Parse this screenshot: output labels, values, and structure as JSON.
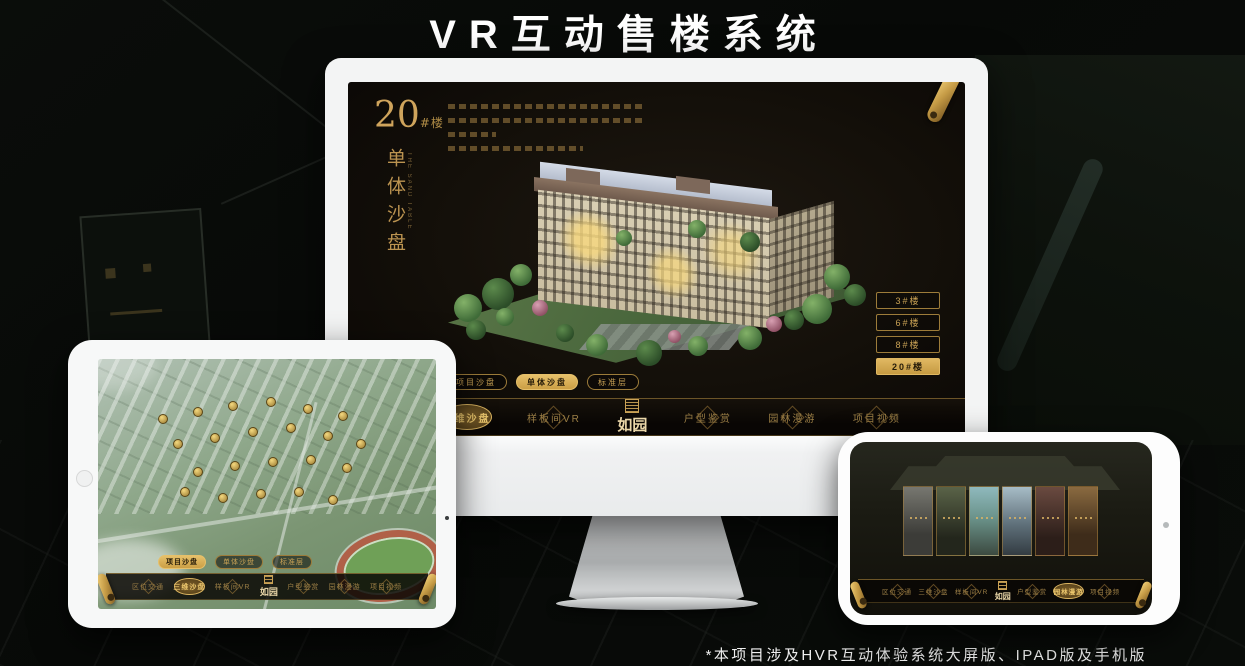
{
  "title": "VR互动售楼系统",
  "footnote": "*本项目涉及HVR互动体验系统大屏版、IPAD版及手机版",
  "brand": {
    "name": "如园",
    "gold": "#c9a257",
    "gold_bright": "#e3c06a",
    "screen_bg": "#14100a"
  },
  "desktop": {
    "block_number": "20",
    "block_unit": "#楼",
    "section_title": "单体沙盘",
    "section_subtitle": "THE SAND TABLE",
    "building_buttons": [
      {
        "label": "3#楼",
        "selected": false
      },
      {
        "label": "6#楼",
        "selected": false
      },
      {
        "label": "8#楼",
        "selected": false
      },
      {
        "label": "20#楼",
        "selected": true
      }
    ],
    "floor_tabs": [
      {
        "label": "项目沙盘",
        "selected": false
      },
      {
        "label": "单体沙盘",
        "selected": true
      },
      {
        "label": "标准层",
        "selected": false
      }
    ],
    "nav_items": [
      {
        "label": "区位交通",
        "selected": false
      },
      {
        "label": "三维沙盘",
        "selected": true
      },
      {
        "label": "样板间VR",
        "selected": false
      },
      {
        "label": "户型鉴赏",
        "selected": false
      },
      {
        "label": "园林漫游",
        "selected": false
      },
      {
        "label": "项目视频",
        "selected": false
      }
    ]
  },
  "tablet": {
    "floor_tabs": [
      {
        "label": "项目沙盘",
        "selected": true
      },
      {
        "label": "单体沙盘",
        "selected": false
      },
      {
        "label": "标准层",
        "selected": false
      }
    ],
    "nav_items": [
      {
        "label": "区位交通",
        "selected": false
      },
      {
        "label": "三维沙盘",
        "selected": true
      },
      {
        "label": "样板间VR",
        "selected": false
      },
      {
        "label": "户型鉴赏",
        "selected": false
      },
      {
        "label": "园林漫游",
        "selected": false
      },
      {
        "label": "项目视频",
        "selected": false
      }
    ]
  },
  "phone": {
    "gallery_count": 6,
    "nav_items": [
      {
        "label": "区位交通",
        "selected": false
      },
      {
        "label": "三维沙盘",
        "selected": false
      },
      {
        "label": "样板间VR",
        "selected": false
      },
      {
        "label": "户型鉴赏",
        "selected": false
      },
      {
        "label": "园林漫游",
        "selected": true
      },
      {
        "label": "项目视频",
        "selected": false
      }
    ]
  }
}
